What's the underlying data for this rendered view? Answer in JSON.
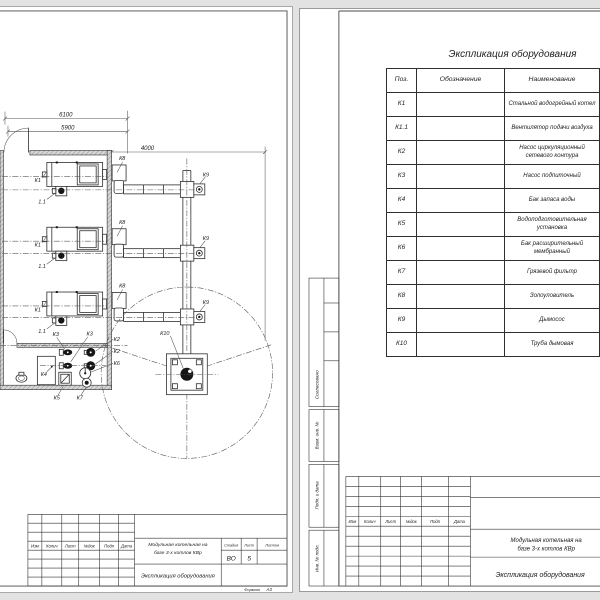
{
  "drawing": {
    "dim_6100": "6100",
    "dim_5900": "5900",
    "dim_4000": "4000",
    "tag_boiler": "К1",
    "tag_fan": "1.1",
    "tag_ash_collector": "К8",
    "tag_smoke_exhauster": "К9",
    "tag_chimney": "К10",
    "tag_circ_pump": "К2",
    "tag_feed_pump": "К3",
    "tag_water_tank": "К4",
    "tag_water_treatment": "К5",
    "tag_expansion_tank": "К6",
    "tag_filter": "К7"
  },
  "equip_table": {
    "title": "Экспликация оборудования",
    "col_pos": "Поз.",
    "col_designation": "Обозначение",
    "col_name": "Наименование",
    "rows": [
      {
        "pos": "К1",
        "name": "Стальной водогрейный котел"
      },
      {
        "pos": "К1.1",
        "name": "Вентилятор подачи воздуха"
      },
      {
        "pos": "К2",
        "name": "Насос циркуляционный сетевого контура"
      },
      {
        "pos": "К3",
        "name": "Насос подпиточный"
      },
      {
        "pos": "К4",
        "name": "Бак запаса воды"
      },
      {
        "pos": "К5",
        "name": "Водоподготовительная установка"
      },
      {
        "pos": "К6",
        "name": "Бак расширительный мембранный"
      },
      {
        "pos": "К7",
        "name": "Грязевой фильтр"
      },
      {
        "pos": "К8",
        "name": "Золоуловитель"
      },
      {
        "pos": "К9",
        "name": "Дымосос"
      },
      {
        "pos": "К10",
        "name": "Труба дымовая"
      }
    ]
  },
  "title_block": {
    "rev_cols": [
      "Изм",
      "Колич",
      "Лист",
      "№док",
      "Подп",
      "Дата"
    ],
    "project_line1": "Модульная котельная на",
    "project_line2": "базе 3-х котлов КВр",
    "doc_name": "Экспликация оборудования",
    "stage_label": "Стадия",
    "sheet_label": "Лист",
    "sheets_label": "Листов",
    "stage": "ВО",
    "sheet": "5",
    "format_label": "Формат",
    "format": "А3"
  },
  "side_stamp": {
    "agreed": "Согласовано",
    "subst_inv": "Взам. инв. №",
    "sign_date": "Подп. и дата",
    "inv_orig": "Инв. № подл."
  }
}
